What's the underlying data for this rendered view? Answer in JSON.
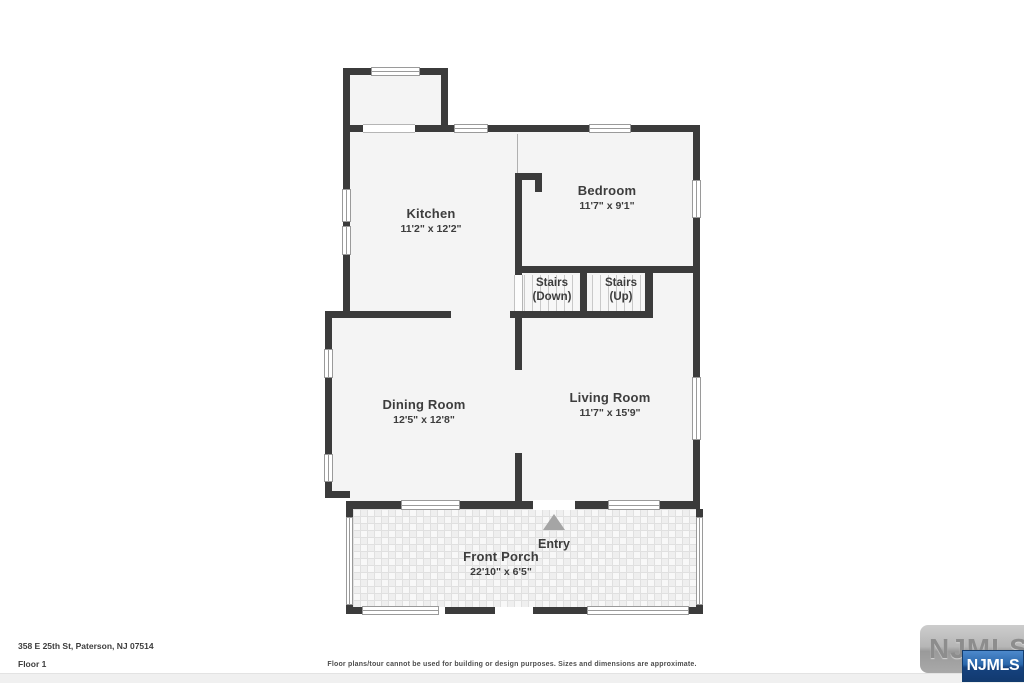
{
  "floorplan": {
    "address": "358 E 25th St, Paterson, NJ 07514",
    "floor": "Floor 1",
    "disclaimer": "Floor plans/tour cannot be used for building or design purposes. Sizes and dimensions are approximate.",
    "entry": "Entry",
    "rooms": {
      "kitchen": {
        "name": "Kitchen",
        "dims": "11'2\" x 12'2\""
      },
      "bedroom": {
        "name": "Bedroom",
        "dims": "11'7\" x 9'1\""
      },
      "stairs_down": {
        "line1": "Stairs",
        "line2": "(Down)"
      },
      "stairs_up": {
        "line1": "Stairs",
        "line2": "(Up)"
      },
      "dining": {
        "name": "Dining Room",
        "dims": "12'5\" x 12'8\""
      },
      "living": {
        "name": "Living Room",
        "dims": "11'7\" x 15'9\""
      },
      "porch": {
        "name": "Front Porch",
        "dims": "22'10\" x 6'5\""
      }
    }
  },
  "branding": {
    "watermark": "NJMLS",
    "badge": "NJMLS"
  },
  "colors": {
    "wall": "#3b3b3b",
    "room_fill": "#f4f4f4",
    "badge_blue": "#15427e",
    "entry_arrow": "#a5a5a5"
  }
}
